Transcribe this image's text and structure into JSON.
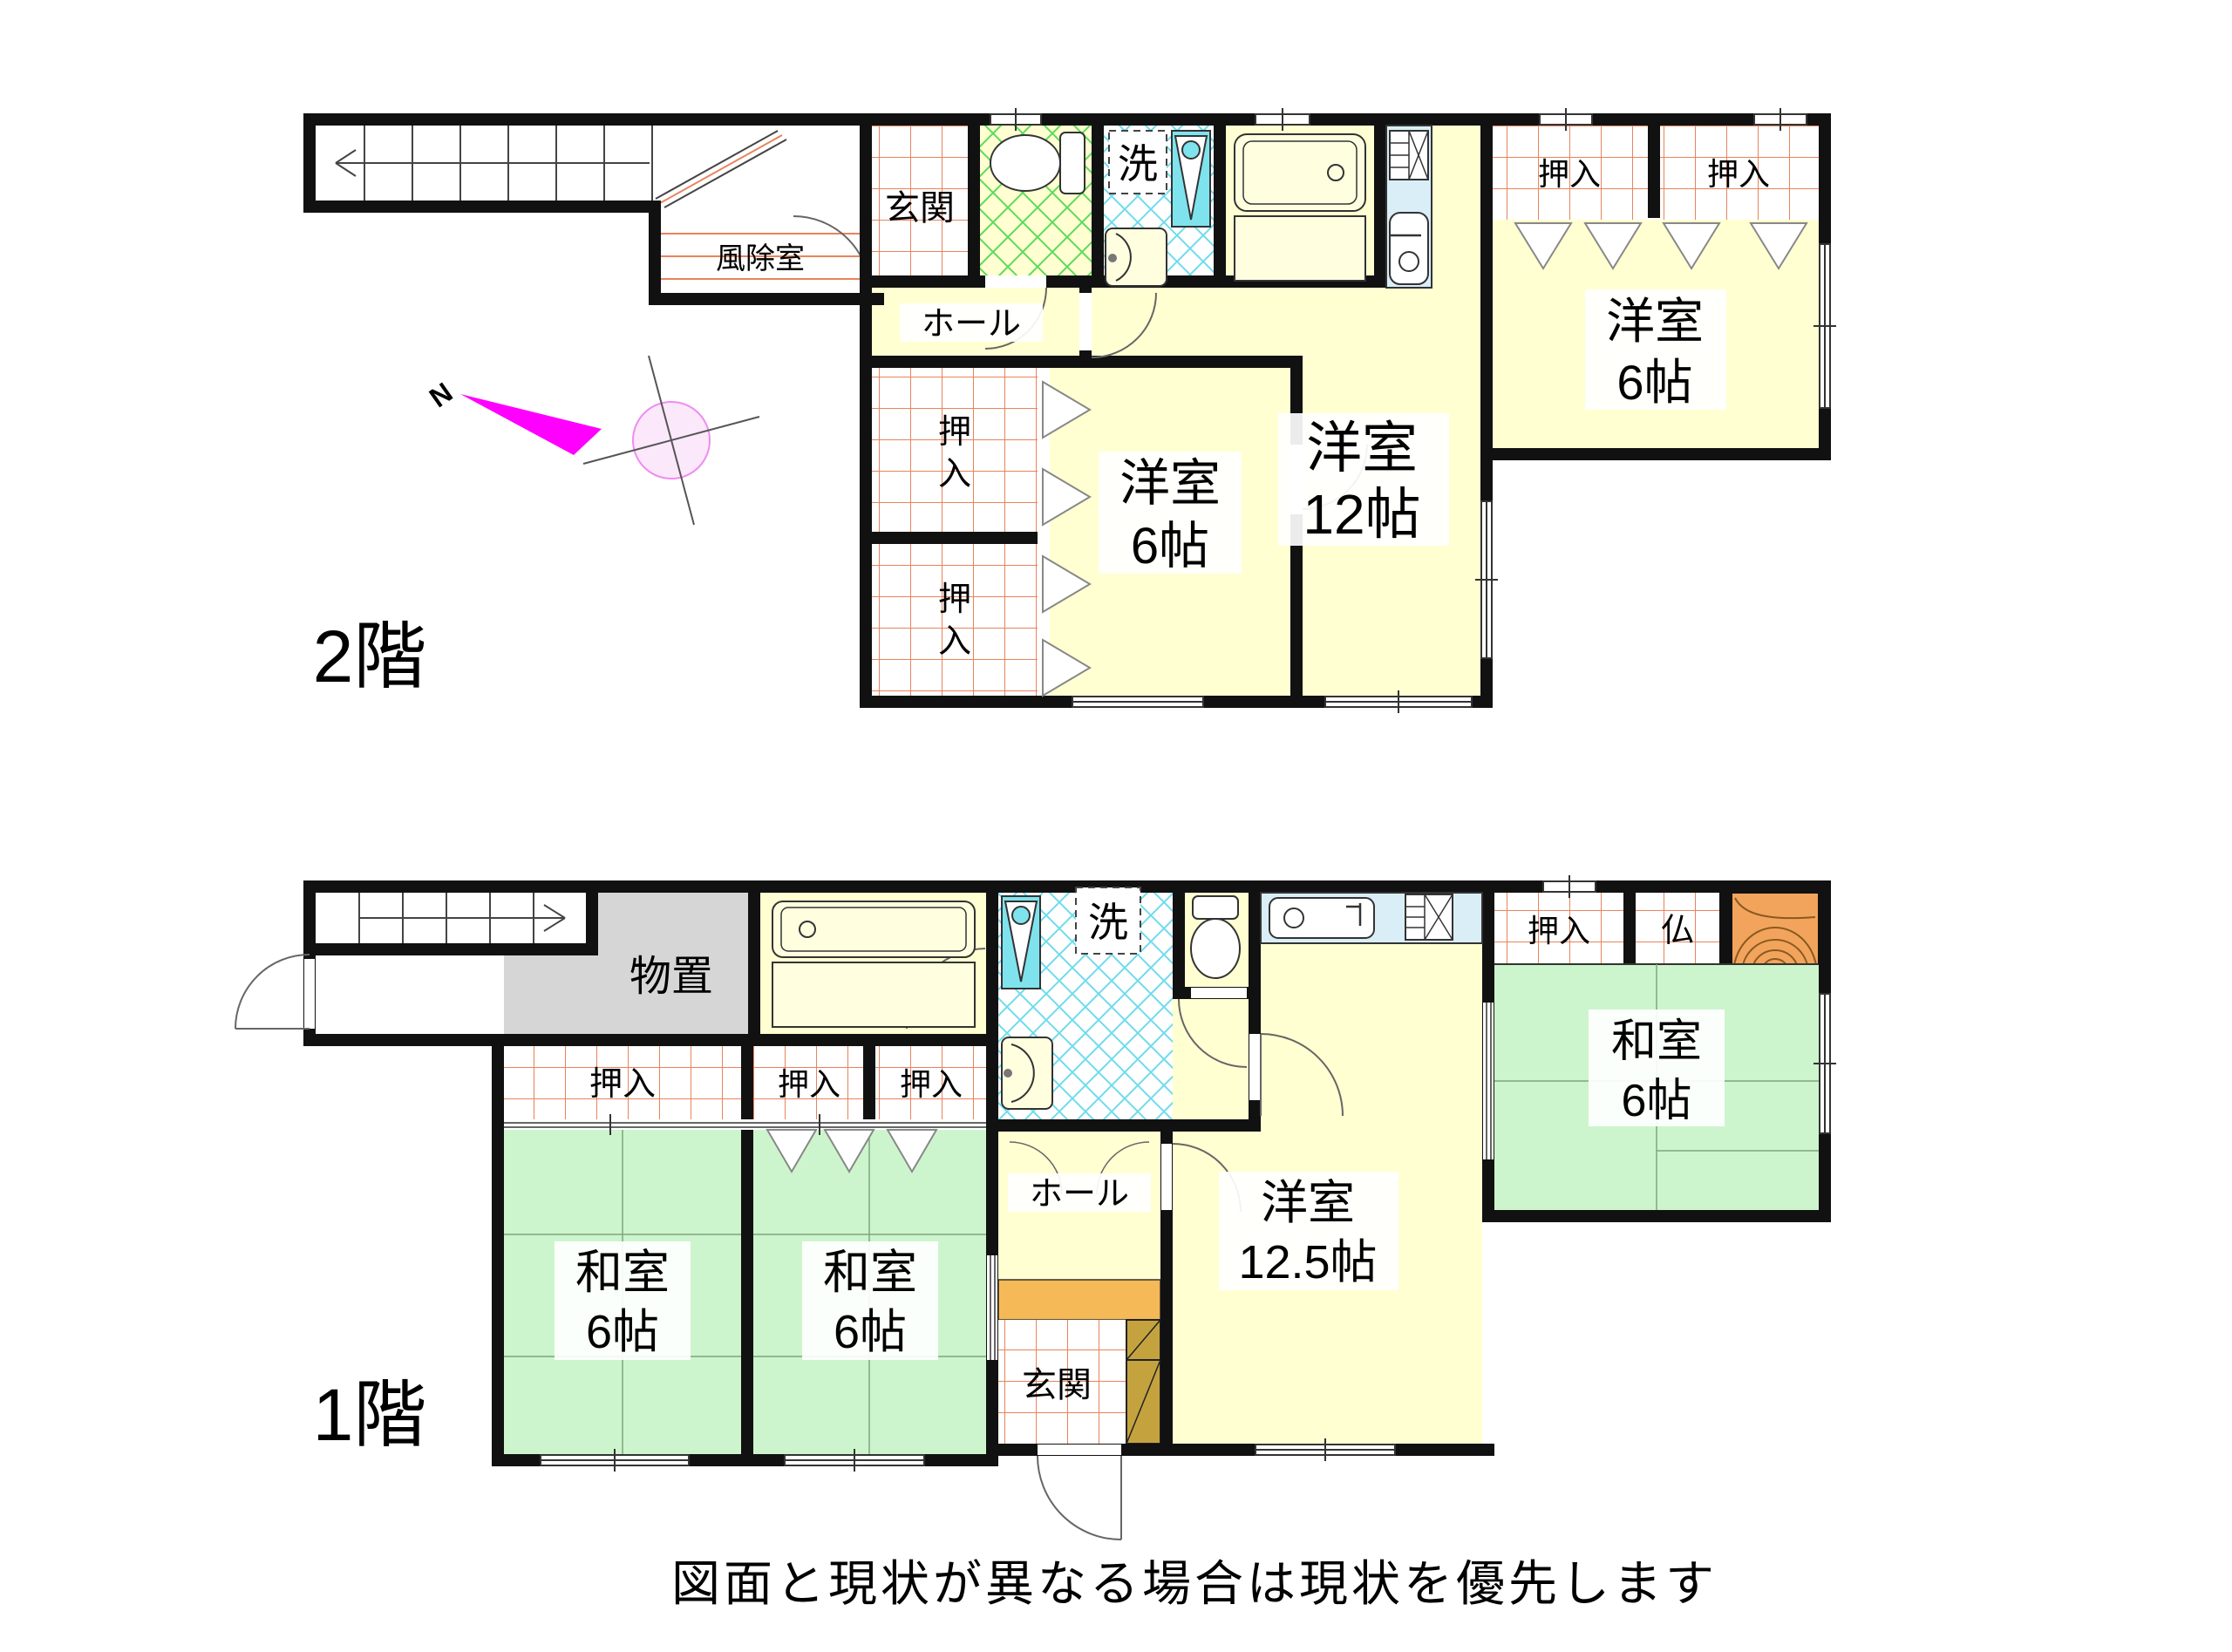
{
  "document": {
    "type": "floor-plan",
    "floor2_label": "2階",
    "floor1_label": "1階",
    "disclaimer": "図面と現状が異なる場合は現状を優先します",
    "compass_north": "N"
  },
  "labels": {
    "genkan": "玄関",
    "fujoshitsu": "風除室",
    "hall": "ホール",
    "wash": "洗",
    "oshiire": "押入",
    "oshiire_c1": "押",
    "oshiire_c2": "入",
    "monooki": "物置",
    "butsudan": "仏",
    "yoshitsu": "洋室",
    "washitsu": "和室",
    "size6": "6帖",
    "size12": "12帖",
    "size12_5": "12.5帖"
  },
  "colors": {
    "wall": "#111111",
    "room_yellow": "#FFFFD2",
    "tatami_green": "#CDF5CD",
    "storage_gray": "#D6D6D6",
    "tile_grid_orange": "#E8845C",
    "wash_lattice_cyan": "#6FDCEC",
    "toilet_lattice_green": "#5ADC5A",
    "counter_blue": "#D9EEF7",
    "step_orange": "#F5B957",
    "shoe_cabinet_tan": "#C4A33F",
    "wood_orange": "#F2A45C",
    "compass_magenta": "#FF00FF",
    "north_red": "#CC1111"
  }
}
